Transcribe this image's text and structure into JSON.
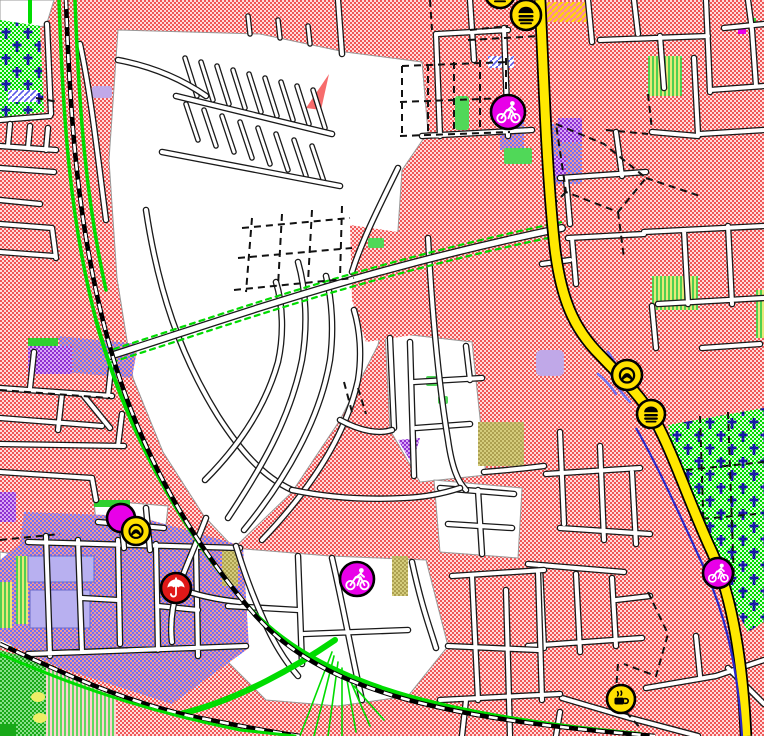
{
  "map": {
    "type": "topographic-cycling-map-tile",
    "width_px": 764,
    "height_px": 736,
    "visible_text": [],
    "colors": {
      "residential_red": "#f05858",
      "residential_dither": "#ffdcdc",
      "unbuilt_white": "#ffffff",
      "major_road_yellow": "#ffe800",
      "major_road_casing": "#000000",
      "minor_road_fill": "#ffffff",
      "minor_road_casing": "#1a1a1a",
      "railway_black": "#000000",
      "railway_dash_white": "#ffffff",
      "cycle_route_green": "#00dc00",
      "cycleway_blue": "#2828c8",
      "cemetery_green": "#00d800",
      "grave_cross_blue": "#1818a8",
      "commercial_blue": "#7070f8",
      "forest_green": "#18a818",
      "orchard_stripe_green": "#60d860",
      "scrub_green_yellow": "#e8e878",
      "brownfield_olive": "#aca050",
      "utility_purple": "#9030d0",
      "lavender_area": "#c0a8e8",
      "poi_yellow": "#ffe000",
      "poi_magenta": "#e800e8",
      "poi_red": "#e01818"
    },
    "features": {
      "areas": [
        "residential-blocks",
        "white-unbuilt-core",
        "cemetery-top-left",
        "cemetery-right",
        "commercial-industrial-southwest",
        "forest-southwest",
        "orchard-southwest",
        "scrub-patches",
        "brownfield-patches",
        "purple-utility-areas",
        "lavender-buildings"
      ],
      "lines": [
        "main-road-yellow",
        "railway-northwest",
        "railway-southwest",
        "green-cycle-routes",
        "tree-lined-avenue",
        "dashed-footpaths",
        "minor-street-grid",
        "allotment-path-grid"
      ]
    },
    "pois": [
      {
        "id": "fast-food-top-edge",
        "icon": "fast-food",
        "label": "fast food",
        "x": 500,
        "y": -7,
        "r": 15,
        "color": "#ffe000",
        "glyph_color": "#000000"
      },
      {
        "id": "fast-food-north",
        "icon": "fast-food",
        "label": "fast food",
        "x": 526,
        "y": 15,
        "r": 15,
        "color": "#ffe000",
        "glyph_color": "#000000"
      },
      {
        "id": "bicycle-shop-north",
        "icon": "cyclist",
        "label": "bicycle",
        "x": 508,
        "y": 112,
        "r": 17,
        "color": "#e800e8",
        "glyph_color": "#ffffff"
      },
      {
        "id": "bakery-east",
        "icon": "pretzel",
        "label": "bakery",
        "x": 627,
        "y": 375,
        "r": 15,
        "color": "#ffe000",
        "glyph_color": "#000000"
      },
      {
        "id": "fast-food-east",
        "icon": "fast-food",
        "label": "fast food",
        "x": 651,
        "y": 414,
        "r": 14,
        "color": "#ffe000",
        "glyph_color": "#000000"
      },
      {
        "id": "poi-west-magenta",
        "icon": "dot",
        "label": "poi",
        "x": 121,
        "y": 518,
        "r": 14,
        "color": "#e800e8",
        "glyph_color": "#ffffff"
      },
      {
        "id": "bakery-west",
        "icon": "pretzel",
        "label": "bakery",
        "x": 136,
        "y": 531,
        "r": 14,
        "color": "#ffe000",
        "glyph_color": "#000000"
      },
      {
        "id": "shelter-west",
        "icon": "umbrella",
        "label": "shelter",
        "x": 176,
        "y": 588,
        "r": 15,
        "color": "#e01818",
        "glyph_color": "#ffffff"
      },
      {
        "id": "bicycle-shop-center",
        "icon": "cyclist",
        "label": "bicycle",
        "x": 357,
        "y": 579,
        "r": 17,
        "color": "#e800e8",
        "glyph_color": "#ffffff"
      },
      {
        "id": "bicycle-shop-southeast",
        "icon": "cyclist",
        "label": "bicycle",
        "x": 718,
        "y": 573,
        "r": 15,
        "color": "#e800e8",
        "glyph_color": "#ffffff"
      },
      {
        "id": "cafe-south",
        "icon": "coffee",
        "label": "cafe",
        "x": 621,
        "y": 699,
        "r": 14,
        "color": "#ffe000",
        "glyph_color": "#000000"
      }
    ]
  }
}
